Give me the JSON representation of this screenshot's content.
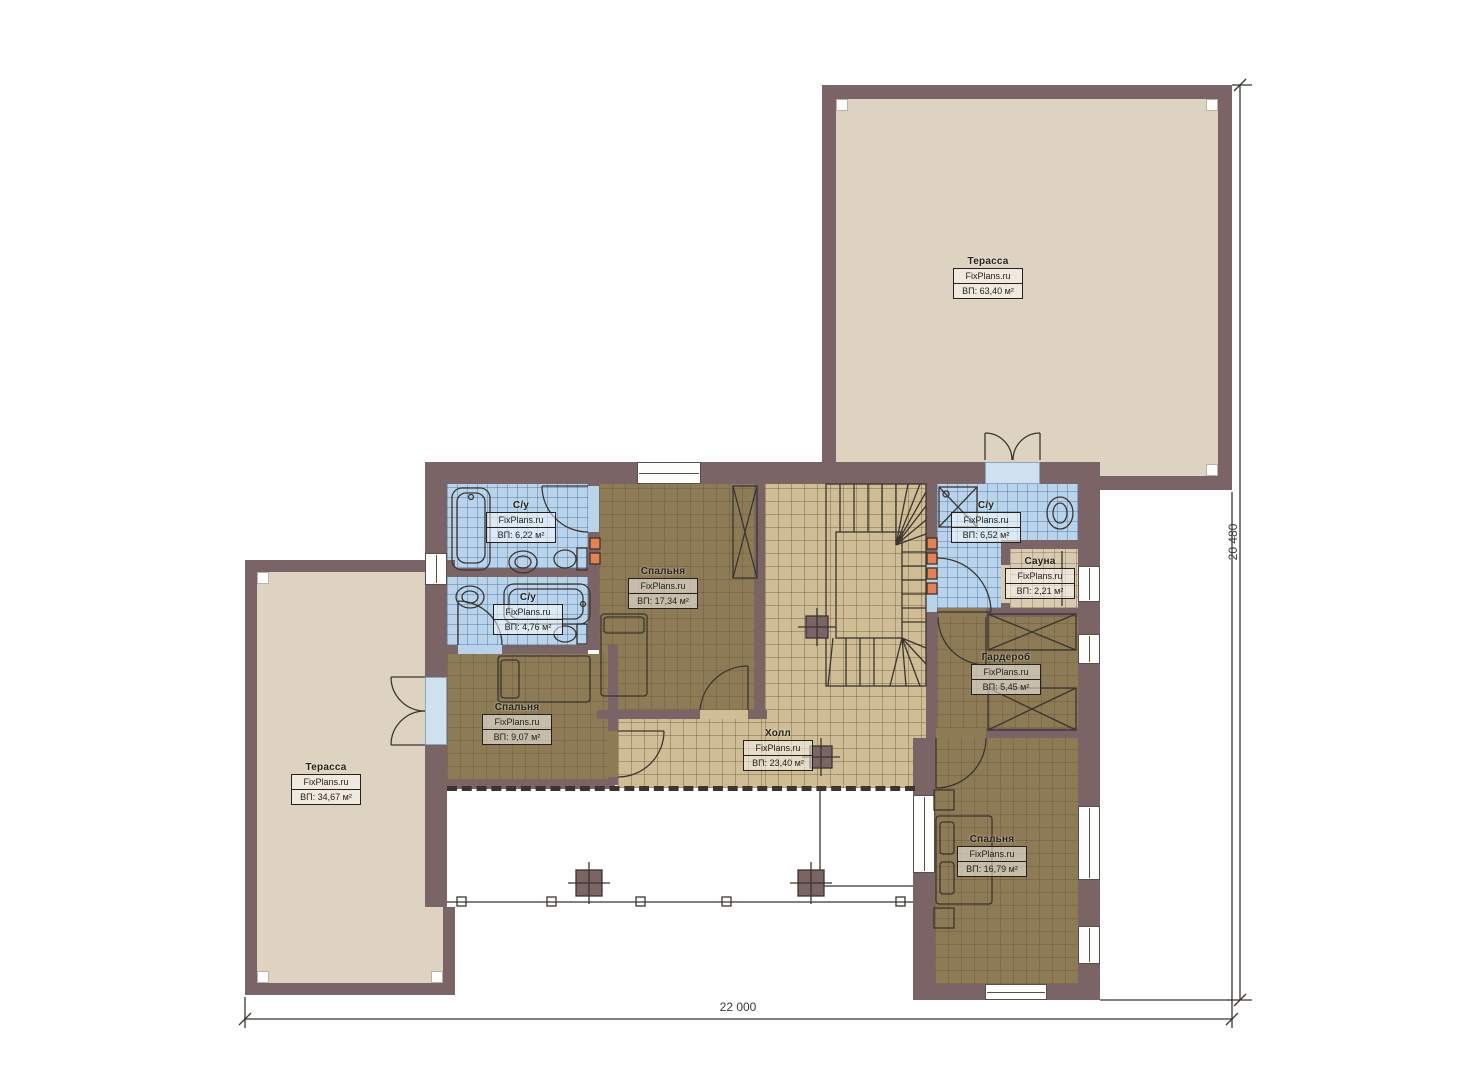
{
  "branding": {
    "watermark": "FixPlans.ru"
  },
  "rooms": [
    {
      "id": "terrace-top",
      "name": "Терасса",
      "area": "ВП: 63,40 м²"
    },
    {
      "id": "terrace-left",
      "name": "Терасса",
      "area": "ВП: 34,67 м²"
    },
    {
      "id": "bathroom-top",
      "name": "С/у",
      "area": "ВП: 6,22 м²"
    },
    {
      "id": "bathroom-mid",
      "name": "С/у",
      "area": "ВП: 4,76 м²"
    },
    {
      "id": "bedroom-top",
      "name": "Спальня",
      "area": "ВП: 17,34 м²"
    },
    {
      "id": "bathroom-right",
      "name": "С/у",
      "area": "ВП: 6,52 м²"
    },
    {
      "id": "sauna",
      "name": "Сауна",
      "area": "ВП: 2,21 м²"
    },
    {
      "id": "wardrobe",
      "name": "Гардероб",
      "area": "ВП: 5,45 м²"
    },
    {
      "id": "hall",
      "name": "Холл",
      "area": "ВП: 23,40 м²"
    },
    {
      "id": "bedroom-left",
      "name": "Спальня",
      "area": "ВП: 9,07 м²"
    },
    {
      "id": "bedroom-bottom",
      "name": "Спальня",
      "area": "ВП: 16,79 м²"
    }
  ],
  "dimensions": {
    "width_label": "22 000",
    "height_label": "20 480"
  },
  "colors": {
    "wall": "#7b6465",
    "terrace_floor": "#ded3c0",
    "wood_floor": "#8d7b56",
    "tile_floor": "#cfbd95",
    "bath_tile": "#b9d4ea",
    "sauna_floor": "#d8cbb0",
    "radiator": "#e8804f",
    "line": "#3b3530"
  }
}
